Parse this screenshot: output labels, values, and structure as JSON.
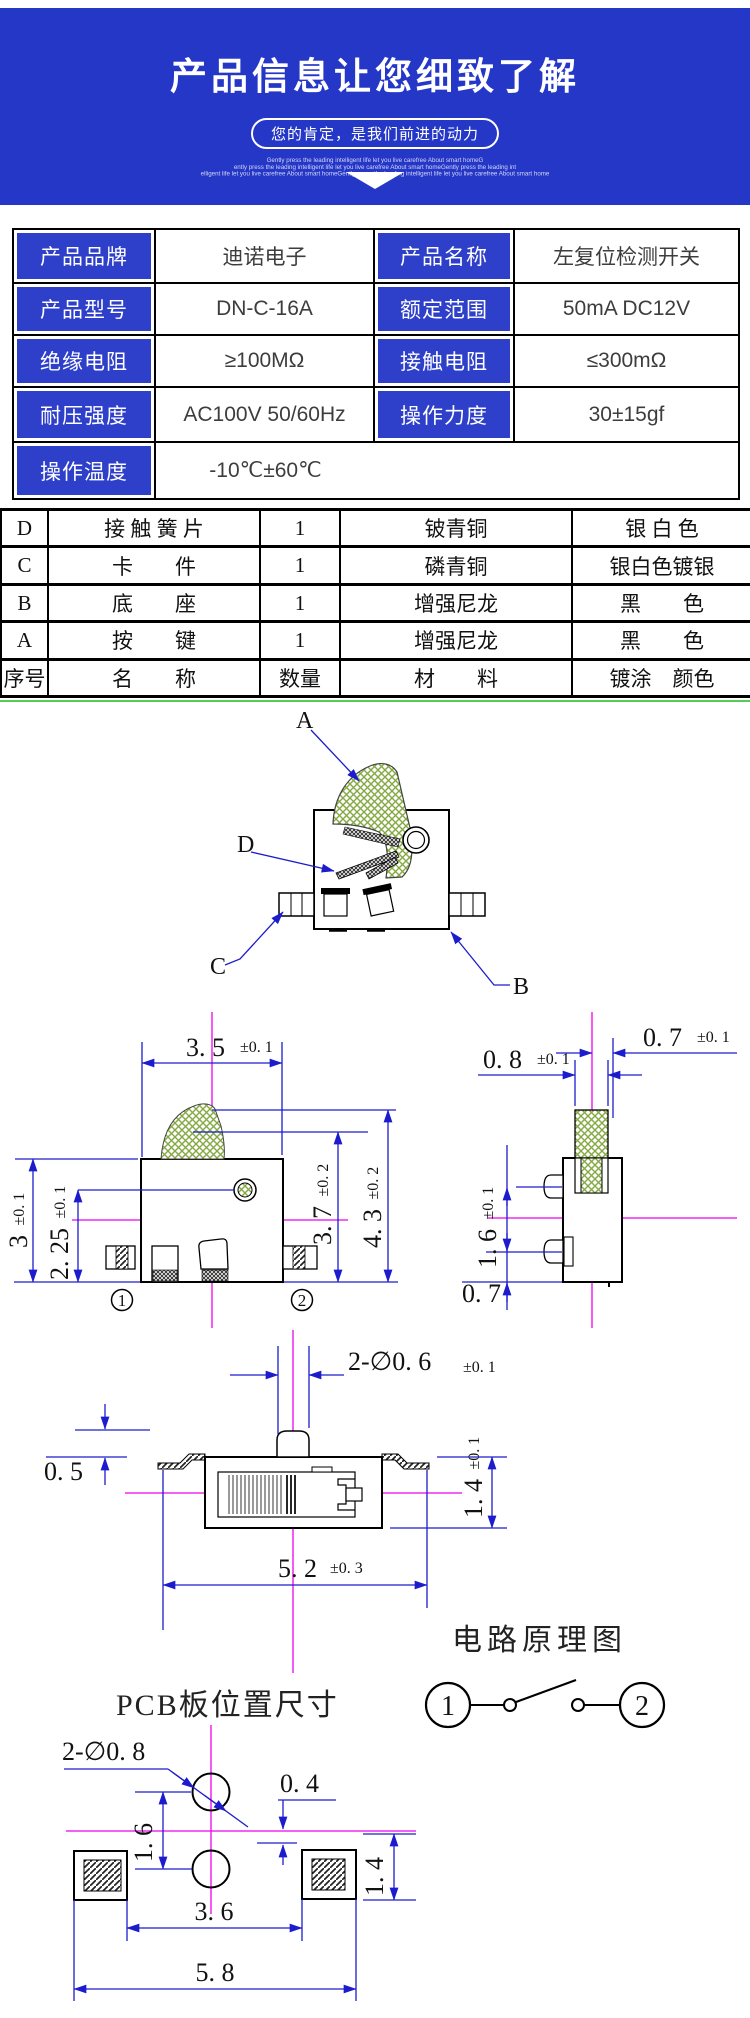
{
  "colors": {
    "hero_blue": "#2537c7",
    "table_label_blue": "#2e3fc9",
    "dimension_blue": "#1c1ccd",
    "centerline_magenta": "#ee00ee",
    "hatch_green": "#84a943",
    "divider_green": "#55cc55"
  },
  "hero": {
    "title": "产品信息让您细致了解",
    "badge": "您的肯定，是我们前进的动力",
    "fineprint": [
      "Gently press the leading intelligent life let you live carefree About smart homeG",
      "ently press the leading intelligent life let you live carefree About smart homeGently press the leading int",
      "elligent life let you live carefree About smart homeGently press the leading intelligent life let you live carefree About smart home"
    ]
  },
  "spec": {
    "rows": [
      {
        "l1": "产品品牌",
        "v1": "迪诺电子",
        "l2": "产品名称",
        "v2": "左复位检测开关"
      },
      {
        "l1": "产品型号",
        "v1": "DN-C-16A",
        "l2": "额定范围",
        "v2": "50mA DC12V"
      },
      {
        "l1": "绝缘电阻",
        "v1": "≥100MΩ",
        "l2": "接触电阻",
        "v2": "≤300mΩ"
      },
      {
        "l1": "耐压强度",
        "v1": "AC100V 50/60Hz",
        "l2": "操作力度",
        "v2": "30±15gf"
      },
      {
        "l1": "操作温度",
        "v1": "-10℃±60℃"
      }
    ]
  },
  "bom": {
    "rows": [
      [
        "D",
        "接 触 簧 片",
        "1",
        "铍青铜",
        "银 白 色"
      ],
      [
        "C",
        "卡　　件",
        "1",
        "磷青铜",
        "银白色镀银"
      ],
      [
        "B",
        "底　　座",
        "1",
        "增强尼龙",
        "黑　　色"
      ],
      [
        "A",
        "按　　键",
        "1",
        "增强尼龙",
        "黑　　色"
      ],
      [
        "序号",
        "名　　称",
        "数量",
        "材　　料",
        "镀涂　颜色"
      ]
    ]
  },
  "assembly": {
    "a": "A",
    "b": "B",
    "c": "C",
    "d": "D"
  },
  "front_view": {
    "dim_width": "3. 5",
    "dim_width_tol": "±0. 1",
    "dim_height": "3",
    "dim_height_tol": "±0. 1",
    "dim_inner": "2. 25",
    "dim_inner_tol": "±0. 1",
    "dim_h2": "3. 7",
    "dim_h2_tol": "±0. 2",
    "dim_h3": "4. 3",
    "dim_h3_tol": "±0. 2",
    "pin1": "1",
    "pin2": "2"
  },
  "side_view": {
    "dim_top": "0. 7",
    "dim_top_tol": "±0. 1",
    "dim_w": "0. 8",
    "dim_w_tol": "±0. 1",
    "dim_pitch": "1. 6",
    "dim_pitch_tol": "±0. 1",
    "dim_bottom": "0. 7"
  },
  "top_view": {
    "dim_holes": "2-∅0. 6",
    "dim_holes_tol": "±0. 1",
    "dim_standoff": "0. 5",
    "dim_h": "1. 4",
    "dim_h_tol": "±0. 1",
    "dim_len": "5. 2",
    "dim_len_tol": "±0. 3"
  },
  "circuit": {
    "title": "电路原理图",
    "pin1": "1",
    "pin2": "2"
  },
  "pcb": {
    "title": "PCB板位置尺寸",
    "dim_holes": "2-∅0. 8",
    "dim_offset": "0. 4",
    "dim_pitch": "1. 6",
    "dim_pad": "1. 4",
    "dim_inner": "3. 6",
    "dim_outer": "5. 8"
  }
}
